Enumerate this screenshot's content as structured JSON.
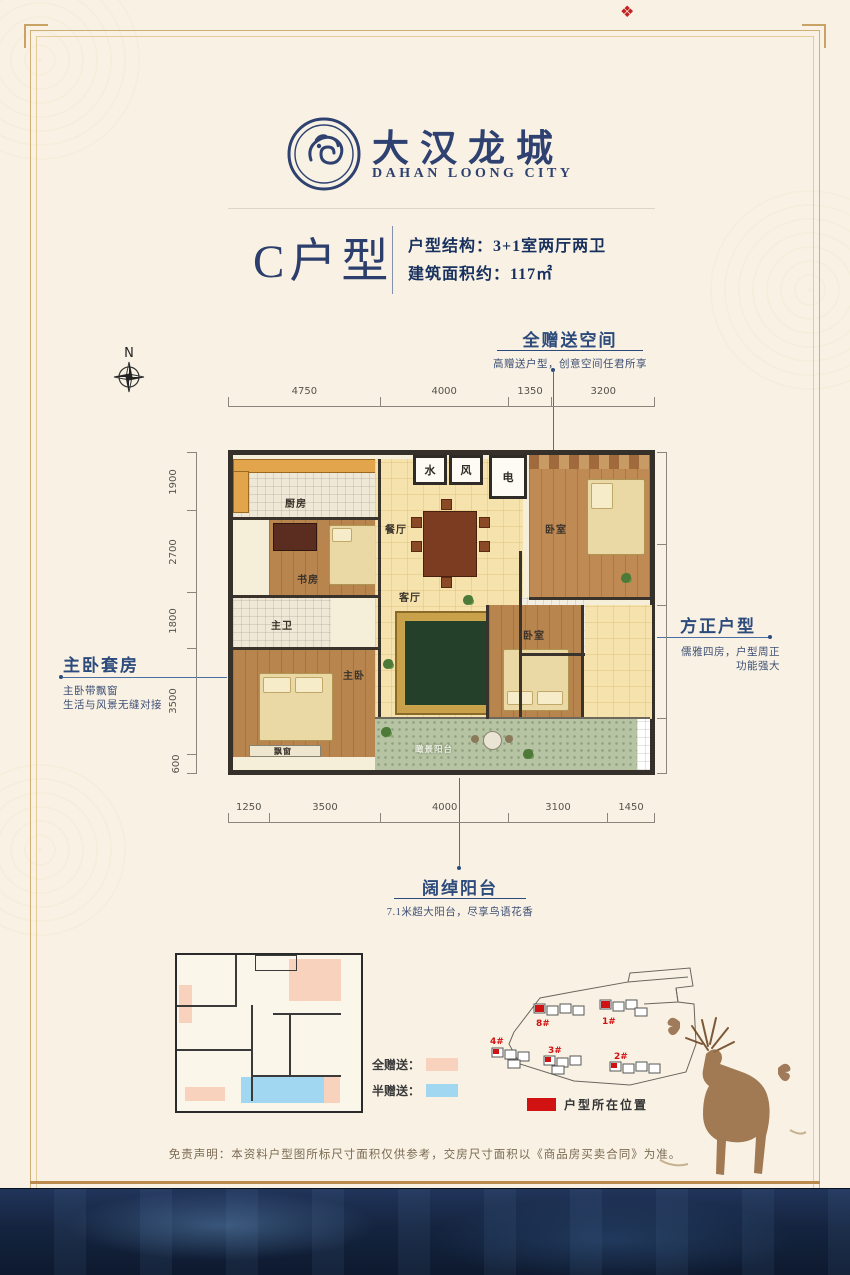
{
  "logo": {
    "cn": "大汉龙城",
    "en": "DAHAN LOONG CITY"
  },
  "stamp_glyph": "❖",
  "title": {
    "unit": "C户型",
    "spec1": "户型结构：3+1室两厅两卫",
    "spec2": "建筑面积约：117㎡"
  },
  "compass": {
    "label": "N"
  },
  "callouts": {
    "top": {
      "title": "全赠送空间",
      "desc": "高赠送户型，创意空间任君所享"
    },
    "left": {
      "title": "主卧套房",
      "desc1": "主卧带飘窗",
      "desc2": "生活与风景无缝对接"
    },
    "right": {
      "title": "方正户型",
      "desc1": "儒雅四房，户型周正",
      "desc2": "功能强大"
    },
    "bottom": {
      "title": "阔绰阳台",
      "desc": "7.1米超大阳台，尽享鸟语花香"
    }
  },
  "dims": {
    "top": [
      4750,
      4000,
      1350,
      3200
    ],
    "bottom": [
      1250,
      3500,
      4000,
      3100,
      1450
    ],
    "left": [
      1900,
      2700,
      1800,
      3500,
      600
    ],
    "right": [
      3000,
      2000,
      3700,
      1800
    ]
  },
  "rooms": {
    "kitchen": "厨房",
    "study": "书房",
    "dining": "餐厅",
    "living": "客厅",
    "master_bath": "主卫",
    "second_bath": "次卫",
    "master_bed": "主卧",
    "bay": "飘窗",
    "bedroom_top": "卧室",
    "bedroom_mid": "卧室",
    "balcony": "瞰景阳台",
    "box_water": "水",
    "box_wind": "风",
    "box_elec": "电"
  },
  "legend": {
    "full": "全赠送：",
    "half": "半赠送：",
    "full_color": "#f8d2bc",
    "half_color": "#a2d7f2"
  },
  "siteplan": {
    "labels": [
      "8#",
      "1#",
      "4#",
      "3#",
      "2#"
    ],
    "legend": "户型所在位置",
    "accent": "#d01212"
  },
  "disclaimer": "免责声明：本资料户型图所标尺寸面积仅供参考，交房尺寸面积以《商品房买卖合同》为准。"
}
